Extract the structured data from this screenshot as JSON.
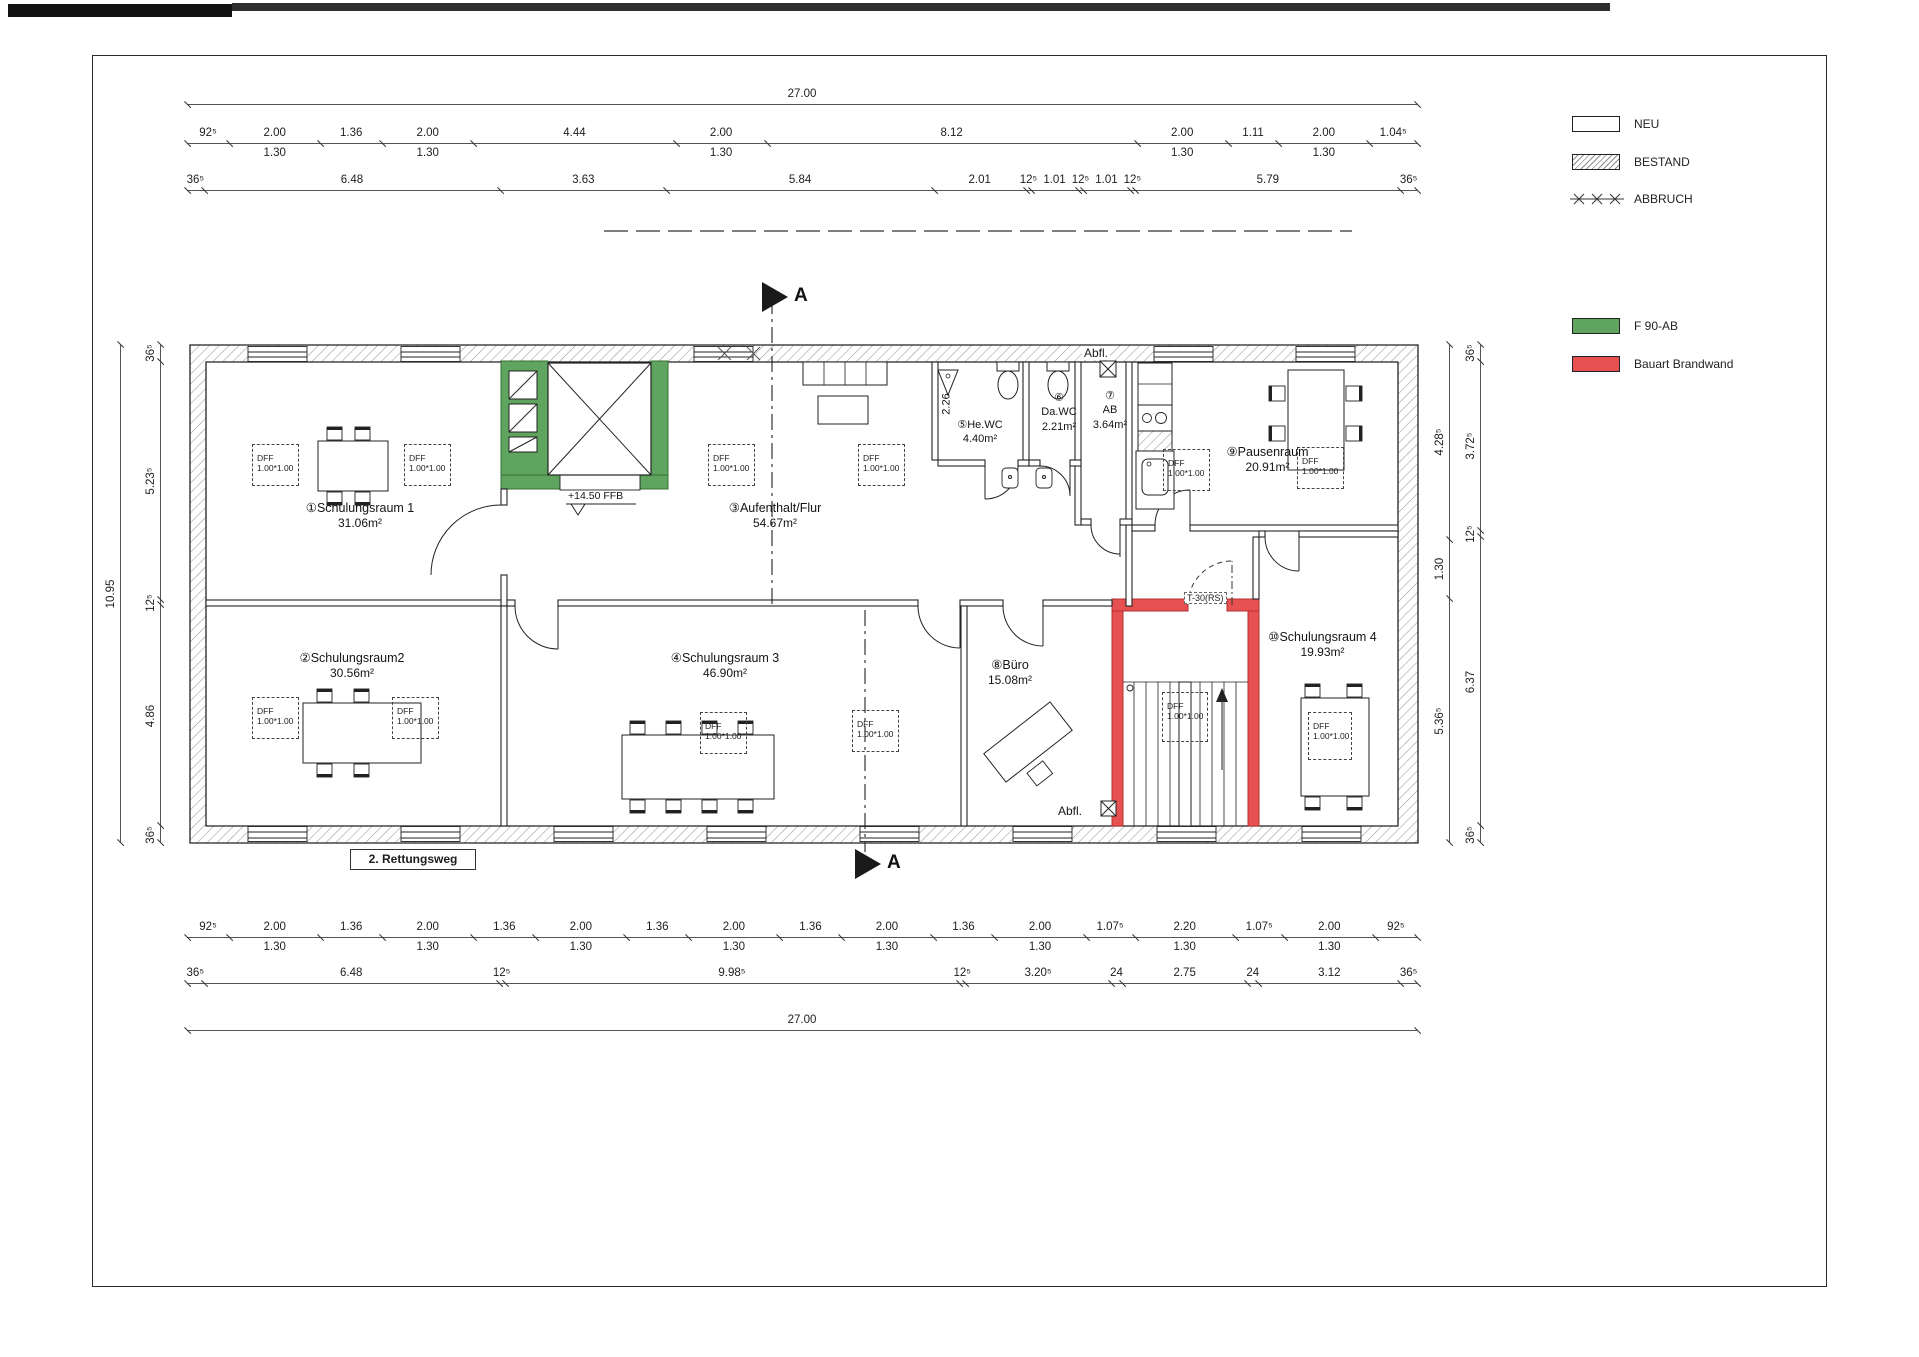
{
  "legend": {
    "items": [
      {
        "label": "NEU",
        "swatch": "neu"
      },
      {
        "label": "BESTAND",
        "swatch": "bestand"
      },
      {
        "label": "ABBRUCH",
        "swatch": "abbruch"
      },
      {
        "label": "F 90-AB",
        "swatch": "green",
        "color": "#5fa55f"
      },
      {
        "label": "Bauart Brandwand",
        "swatch": "red",
        "color": "#e85151"
      }
    ]
  },
  "dims": {
    "overall_top": {
      "values": [
        {
          "d": "27.00",
          "m": 27.0
        }
      ]
    },
    "overall_bottom": {
      "values": [
        {
          "d": "27.00",
          "m": 27.0
        }
      ]
    },
    "overall_left": {
      "values": [
        {
          "d": "10.95",
          "m": 10.95
        }
      ]
    },
    "top_row1": {
      "values": [
        {
          "d": "92⁵",
          "m": 0.925
        },
        {
          "d": "2.00",
          "m": 2.0,
          "sub": "1.30"
        },
        {
          "d": "1.36",
          "m": 1.36
        },
        {
          "d": "2.00",
          "m": 2.0,
          "sub": "1.30"
        },
        {
          "d": "4.44",
          "m": 4.44
        },
        {
          "d": "2.00",
          "m": 2.0,
          "sub": "1.30"
        },
        {
          "d": "8.12",
          "m": 8.12
        },
        {
          "d": "2.00",
          "m": 2.0,
          "sub": "1.30"
        },
        {
          "d": "1.11",
          "m": 1.11
        },
        {
          "d": "2.00",
          "m": 2.0,
          "sub": "1.30"
        },
        {
          "d": "1.04⁵",
          "m": 1.045
        }
      ]
    },
    "top_row2": {
      "values": [
        {
          "d": "36⁵",
          "m": 0.365
        },
        {
          "d": "6.48",
          "m": 6.48
        },
        {
          "d": "3.63",
          "m": 3.63
        },
        {
          "d": "5.84",
          "m": 5.84
        },
        {
          "d": "2.01",
          "m": 2.01
        },
        {
          "d": "12⁵",
          "m": 0.125
        },
        {
          "d": "1.01",
          "m": 1.01
        },
        {
          "d": "12⁵",
          "m": 0.125
        },
        {
          "d": "1.01",
          "m": 1.01
        },
        {
          "d": "12⁵",
          "m": 0.125
        },
        {
          "d": "5.79",
          "m": 5.79
        },
        {
          "d": "36⁵",
          "m": 0.365
        }
      ]
    },
    "bottom_row1": {
      "values": [
        {
          "d": "92⁵",
          "m": 0.925
        },
        {
          "d": "2.00",
          "m": 2.0,
          "sub": "1.30"
        },
        {
          "d": "1.36",
          "m": 1.36
        },
        {
          "d": "2.00",
          "m": 2.0,
          "sub": "1.30"
        },
        {
          "d": "1.36",
          "m": 1.36
        },
        {
          "d": "2.00",
          "m": 2.0,
          "sub": "1.30"
        },
        {
          "d": "1.36",
          "m": 1.36
        },
        {
          "d": "2.00",
          "m": 2.0,
          "sub": "1.30"
        },
        {
          "d": "1.36",
          "m": 1.36
        },
        {
          "d": "2.00",
          "m": 2.0,
          "sub": "1.30"
        },
        {
          "d": "1.36",
          "m": 1.36
        },
        {
          "d": "2.00",
          "m": 2.0,
          "sub": "1.30"
        },
        {
          "d": "1.07⁵",
          "m": 1.075
        },
        {
          "d": "2.20",
          "m": 2.2,
          "sub": "1.30"
        },
        {
          "d": "1.07⁵",
          "m": 1.075
        },
        {
          "d": "2.00",
          "m": 2.0,
          "sub": "1.30"
        },
        {
          "d": "92⁵",
          "m": 0.925
        }
      ]
    },
    "bottom_row2": {
      "values": [
        {
          "d": "36⁵",
          "m": 0.365
        },
        {
          "d": "6.48",
          "m": 6.48
        },
        {
          "d": "12⁵",
          "m": 0.125
        },
        {
          "d": "9.98⁵",
          "m": 9.985
        },
        {
          "d": "12⁵",
          "m": 0.125
        },
        {
          "d": "3.20⁵",
          "m": 3.205
        },
        {
          "d": "24",
          "m": 0.24
        },
        {
          "d": "2.75",
          "m": 2.75
        },
        {
          "d": "24",
          "m": 0.24
        },
        {
          "d": "3.12",
          "m": 3.12
        },
        {
          "d": "36⁵",
          "m": 0.365
        }
      ]
    },
    "left_chain": {
      "values": [
        {
          "d": "36⁵",
          "m": 0.365
        },
        {
          "d": "5.23⁵",
          "m": 5.235
        },
        {
          "d": "12⁵",
          "m": 0.125
        },
        {
          "d": "4.86",
          "m": 4.86
        },
        {
          "d": "36⁵",
          "m": 0.365
        }
      ]
    },
    "right_inner": {
      "values": [
        {
          "d": "4.28⁵",
          "m": 4.285
        },
        {
          "d": "1.30",
          "m": 1.3
        },
        {
          "d": "5.36⁵",
          "m": 5.365
        }
      ]
    },
    "right_outer": {
      "values": [
        {
          "d": "36⁵",
          "m": 0.365
        },
        {
          "d": "3.72⁵",
          "m": 3.725
        },
        {
          "d": "12⁵",
          "m": 0.125
        },
        {
          "d": "6.37",
          "m": 6.37
        },
        {
          "d": "36⁵",
          "m": 0.365
        }
      ]
    }
  },
  "rooms": [
    {
      "title": "①Schulungsraum 1",
      "area": "31.06m²"
    },
    {
      "title": "②Schulungsraum2",
      "area": "30.56m²"
    },
    {
      "title": "③Aufenthalt/Flur",
      "area": "54.67m²"
    },
    {
      "title": "④Schulungsraum 3",
      "area": "46.90m²"
    },
    {
      "title": "⑤He.WC",
      "area": "4.40m²"
    },
    {
      "num": "⑥",
      "name": "Da.WC",
      "area": "2.21m²"
    },
    {
      "num": "⑦",
      "name": "AB",
      "area": "3.64m²"
    },
    {
      "title": "⑧Büro",
      "area": "15.08m²"
    },
    {
      "title": "⑨Pausenraum",
      "area": "20.91m²"
    },
    {
      "title": "⑩Schulungsraum 4",
      "area": "19.93m²"
    }
  ],
  "labels": {
    "ffb": "+14.50 FFB",
    "rettungsweg": "2. Rettungsweg",
    "abfl_top": "Abfl.",
    "abfl_bottom": "Abfl.",
    "t30": "T-30(RS)",
    "wc_height": "2.26",
    "section_top": "A",
    "section_bottom": "A",
    "dff": "DFF",
    "dff_size": "1.00*1.00"
  }
}
